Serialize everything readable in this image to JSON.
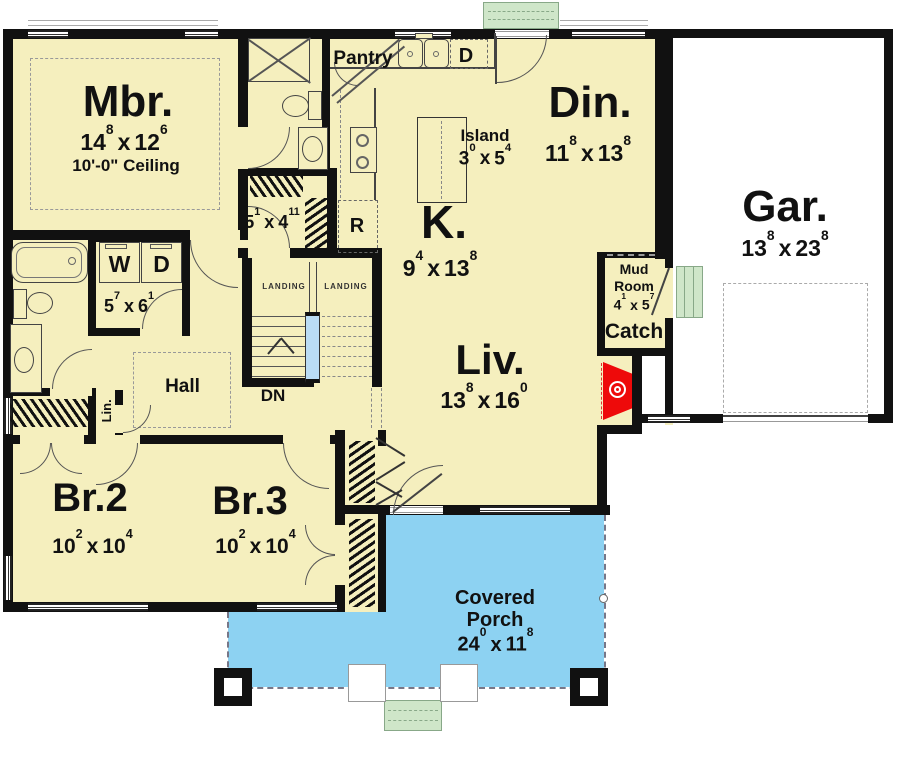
{
  "colors": {
    "floor": "#f5efbe",
    "porch_blue": "#8dd2f2",
    "stoop_green": "#cfe6c9",
    "fireplace_red": "#ee0a0a",
    "stair_rail_blue": "#badcf5",
    "wall_black": "#111111",
    "garage_white": "#ffffff"
  },
  "plan": {
    "mbr": {
      "label": "Mbr.",
      "ceiling": "10'-0\" Ceiling",
      "dim": {
        "w": "14",
        "ws": "8",
        "x": "x",
        "h": "12",
        "hs": "6"
      }
    },
    "din": {
      "label": "Din.",
      "dim": {
        "w": "11",
        "ws": "8",
        "x": "x",
        "h": "13",
        "hs": "8"
      }
    },
    "gar": {
      "label": "Gar.",
      "dim": {
        "w": "13",
        "ws": "8",
        "x": "x",
        "h": "23",
        "hs": "8"
      }
    },
    "kitchen": {
      "label": "K.",
      "dim": {
        "w": "9",
        "ws": "4",
        "x": "x",
        "h": "13",
        "hs": "8"
      }
    },
    "island": {
      "label": "Island",
      "dim": {
        "w": "3",
        "ws": "0",
        "x": "x",
        "h": "5",
        "hs": "4"
      }
    },
    "liv": {
      "label": "Liv.",
      "dim": {
        "w": "13",
        "ws": "8",
        "x": "x",
        "h": "16",
        "hs": "0"
      }
    },
    "br2": {
      "label": "Br.2",
      "dim": {
        "w": "10",
        "ws": "2",
        "x": "x",
        "h": "10",
        "hs": "4"
      }
    },
    "br3": {
      "label": "Br.3",
      "dim": {
        "w": "10",
        "ws": "2",
        "x": "x",
        "h": "10",
        "hs": "4"
      }
    },
    "porch": {
      "line1": "Covered",
      "line2": "Porch",
      "dim": {
        "w": "24",
        "ws": "0",
        "x": "x",
        "h": "11",
        "hs": "8"
      }
    },
    "mud": {
      "line1": "Mud",
      "line2": "Room",
      "dim": {
        "w": "4",
        "ws": "1",
        "x": "x",
        "h": "5",
        "hs": "7"
      }
    },
    "catch": {
      "label": "Catch"
    },
    "hall": {
      "label": "Hall"
    },
    "pantry": {
      "label": "Pantry"
    },
    "laundry": {
      "washer": "W",
      "dryer": "D",
      "dim": {
        "w": "5",
        "ws": "7",
        "x": "x",
        "h": "6",
        "hs": "1"
      }
    },
    "mcloset": {
      "dim": {
        "w": "5",
        "ws": "1",
        "x": "x",
        "h": "4",
        "hs": "11"
      }
    },
    "lin": {
      "label": "Lin."
    },
    "dishwasher": {
      "label": "D"
    },
    "fridge": {
      "label": "R"
    },
    "stairs": {
      "landing_left": "LANDING",
      "landing_right": "LANDING",
      "down": "DN"
    }
  }
}
